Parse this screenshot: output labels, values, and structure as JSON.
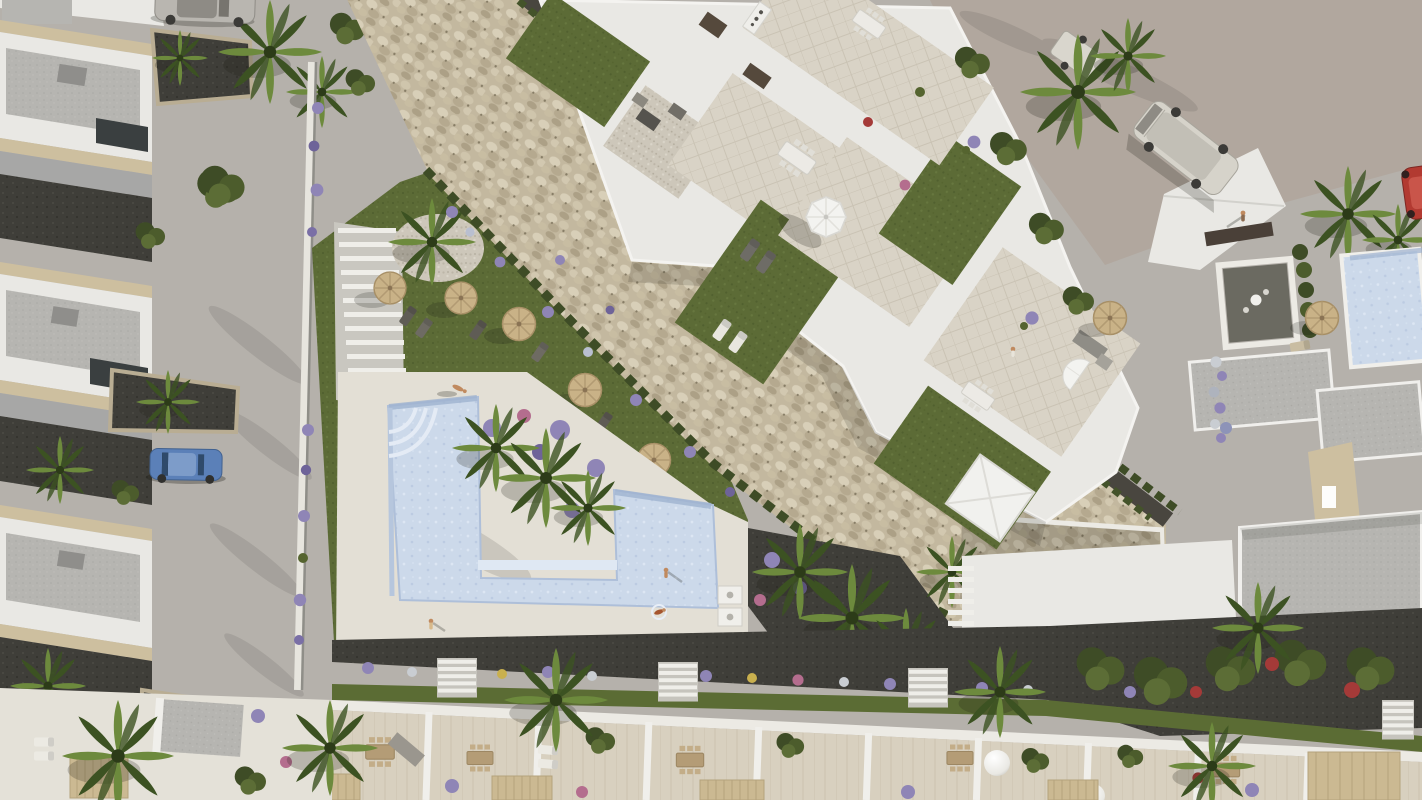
{
  "scene": {
    "type": "aerial-3d-architectural-rendering",
    "view": "top-down bird's eye",
    "time_of_day": "daytime, sunlight from upper right",
    "no_visible_text": true,
    "description": "Top-down aerial 3D rendering of a white Mediterranean residential complex: a diagonal apartment block with rooftop terraces (lawns, patios, dining sets, white parasol), a communal L-shaped swimming pool with white sun deck, landscaped gardens with straw umbrellas and sun loungers, a wide diagonal cobblestone embankment with hedgerows, rows of white townhouses with private terraces at the bottom, detached villas along the left street with parked cars, and neighbouring white buildings, a van and a red car on the upper-right plaza.",
    "aria_label": "Aerial rendering of a white residential complex with swimming pool, gardens, palm trees, cobblestone embankment and surrounding streets with parked vehicles"
  },
  "palette": {
    "street": "#b5b1ab",
    "plaza": "#b1a79e",
    "white": "#e9e8e4",
    "white_bright": "#f4f3f0",
    "wall_shade": "#a7a7a6",
    "roof_gray": "#b6b5b1",
    "roof_dark": "#8f8e8b",
    "coping": "#cdbf9f",
    "lawn": "#5c6b36",
    "lawn_dark": "#49582c",
    "hedge": "#3e4c26",
    "palm_light": "#6d8a3d",
    "palm_dark": "#3c5222",
    "cobble": "#c3b89f",
    "cobble_dark": "#9a8f78",
    "mulch": "#3f3e39",
    "dark_path": "#49463f",
    "pool": "#ccd9ea",
    "pool_shadow": "#9fb3d0",
    "deck": "#e3dfd5",
    "tile": "#d9d3c6",
    "terrace_floor": "#d8d0bf",
    "straw": "#c9b287",
    "umbrella_white": "#f3f3f0",
    "flower_purple": "#8f85b6",
    "flower_pink": "#b46d8e",
    "flower_red": "#a43a38",
    "furniture": "#9a968e",
    "wood": "#b49c76",
    "car_silver": "#b9b6b0",
    "car_blue": "#5b80b8",
    "van_white": "#d6d3ca",
    "car_red": "#b23a31",
    "skin": "#c08a5f",
    "stone_veneer": "#cdbfa0"
  },
  "inventory": {
    "vehicles": [
      {
        "name": "silver-car",
        "color": "#b9b6b0",
        "location": "top-left street, clipped by top edge"
      },
      {
        "name": "blue-car",
        "color": "#5b80b8",
        "location": "left street parking bay"
      },
      {
        "name": "white-van",
        "color": "#d6d3ca",
        "location": "upper-right plaza, parked diagonally"
      },
      {
        "name": "box-trailer",
        "color": "#d9d6cd",
        "location": "upper-right plaza near palms"
      },
      {
        "name": "red-car",
        "color": "#b23a31",
        "location": "right edge, clipped"
      }
    ],
    "people": [
      {
        "pose": "sunbathing",
        "location": "pool deck upper edge"
      },
      {
        "pose": "walking",
        "location": "pool deck lower left"
      },
      {
        "pose": "standing",
        "location": "pool deck south-east corner"
      },
      {
        "pose": "swimming",
        "location": "inside pool"
      },
      {
        "pose": "standing",
        "location": "apartment rooftop terrace"
      },
      {
        "pose": "walking",
        "location": "upper-right plaza"
      }
    ],
    "umbrellas": {
      "straw_parasols": 7,
      "white_parasols": 2,
      "white_dome_lamps": 3
    },
    "pool": {
      "shape": "stepped L/Z shape",
      "water_color": "#ccd9ea",
      "features": [
        "corner steps",
        "deck peninsula",
        "outdoor showers"
      ]
    },
    "vegetation": {
      "palm_trees": 20,
      "hedgerows": 5,
      "flower_colors": [
        "purple",
        "white",
        "pink",
        "red"
      ]
    },
    "structures": {
      "left": "row of detached white villas with gray roof decks and front planting beds",
      "center": "diagonal apartment block with rooftop lawn terraces, pebble courtyards and dining patios",
      "center_low": "communal pool garden with straw umbrellas, loungers and staircase",
      "diagonal_band": "wide cobblestone embankment with dark footpath and hedges",
      "bottom": "row of townhouse back terraces with pergolas, dining sets and dome lamps",
      "right": "neighbouring white buildings, courtyard garden, private pool and gray flat roofs"
    }
  }
}
